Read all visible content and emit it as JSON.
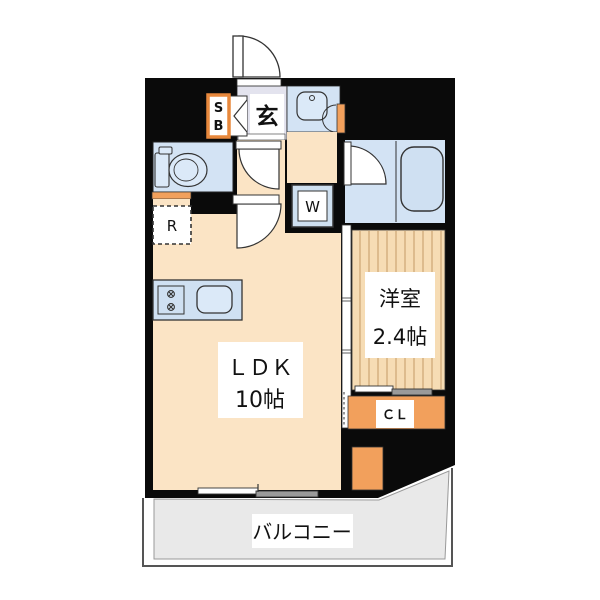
{
  "document": {
    "type": "japanese-apartment-floor-plan",
    "canvas": {
      "width": 600,
      "height": 600
    }
  },
  "labels": {
    "entrance": "玄",
    "shoe_box_line1": "S",
    "shoe_box_line2": "B",
    "washer": "W",
    "refrigerator": "R",
    "ldk_line1": "ＬＤＫ",
    "ldk_line2": "10帖",
    "western_room_line1": "洋室",
    "western_room_line2": "2.4帖",
    "closet": "ＣＬ",
    "balcony": "バルコニー"
  },
  "rooms": [
    {
      "name": "entrance-hall",
      "label": "玄"
    },
    {
      "name": "shoe-box",
      "label": "SB"
    },
    {
      "name": "toilet",
      "label": ""
    },
    {
      "name": "washbasin",
      "label": ""
    },
    {
      "name": "bathroom",
      "label": ""
    },
    {
      "name": "washer-space",
      "label": "W"
    },
    {
      "name": "refrigerator-space",
      "label": "R"
    },
    {
      "name": "ldk",
      "label": "ＬＤＫ 10帖"
    },
    {
      "name": "western-room",
      "label": "洋室 2.4帖"
    },
    {
      "name": "closet",
      "label": "ＣＬ"
    },
    {
      "name": "balcony",
      "label": "バルコニー"
    }
  ],
  "colors": {
    "wall": "#0a0a0a",
    "floor_cream": "#fbe4c5",
    "room_blue": "#d3e3f4",
    "fixture_blue": "#dbe9f8",
    "wood_floor": "#f6dcb4",
    "wood_stripe": "#c49a66",
    "accent_orange": "#f2a05c",
    "shoebox_border": "#e8883c",
    "entrance_floor": "#e3e3ee",
    "balcony_gray": "#e9e9e9",
    "slider_gray": "#9a9a9a",
    "label_bg": "#ffffff"
  }
}
